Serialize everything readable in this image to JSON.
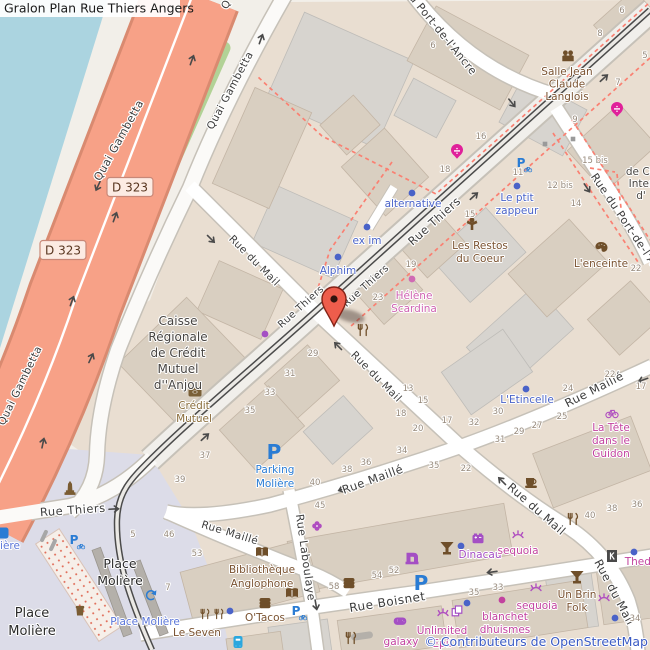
{
  "title": "Gralon Plan Rue Thiers Angers",
  "attribution": "© Contributeurs de OpenStreetMap",
  "colors": {
    "water": "#abd4e0",
    "land": "#f2efe9",
    "block": "#e9ded1",
    "square": "#dcdce8",
    "trunk_road": "#f7a187",
    "trunk_casing": "#d98a70",
    "grass": "#b2d296",
    "road_white": "#ffffff",
    "road_casing": "#c6c1b8",
    "main_road": "#f1efeb",
    "tram": "#4b4b4b",
    "building_tan": "#d9cfc1",
    "building_gray": "#d7d4cf",
    "footway_dashed": "#fa8072",
    "marker_red": "#ee5d4c",
    "street_text": "#3c3c3c",
    "housenumber_text": "#96897b",
    "office_blue": "#4a63c8",
    "amenity_brown": "#7a5230",
    "bank_brown": "#8a6d3b",
    "shop_pink": "#c2429f",
    "health_pink": "#cf63b2",
    "purple_shop": "#a44fc4",
    "parking_blue": "#2a7cd4",
    "transit_blue": "#5a75d8",
    "pharmacy_magenta": "#e0219a",
    "attribution_blue": "#3b5bc4"
  },
  "road_shields": [
    {
      "text": "D 323",
      "x": 130,
      "y": 187
    },
    {
      "text": "D 323",
      "x": 63,
      "y": 250
    }
  ],
  "street_labels": [
    {
      "text": "Quai Gambetta",
      "x": 122,
      "y": 142,
      "rot": -61,
      "size": 11
    },
    {
      "text": "Quai Gambetta",
      "x": 233,
      "y": 92,
      "rot": -62,
      "size": 10.5
    },
    {
      "text": "Quai Gambetta",
      "x": 23,
      "y": 387,
      "rot": -64,
      "size": 10.5
    },
    {
      "text": "Q",
      "x": 229,
      "y": 6,
      "rot": -62,
      "size": 10.5
    },
    {
      "text": "Rue Thiers",
      "x": 437,
      "y": 224,
      "rot": -42,
      "size": 11.5
    },
    {
      "text": "Rue Thiers",
      "x": 368,
      "y": 288,
      "rot": -42,
      "size": 10
    },
    {
      "text": "Rue Thiers",
      "x": 303,
      "y": 309,
      "rot": -42,
      "size": 10
    },
    {
      "text": "Rue Thiers",
      "x": 73,
      "y": 514,
      "rot": -4,
      "size": 11.5
    },
    {
      "text": "Rue du Mail",
      "x": 252,
      "y": 263,
      "rot": 45,
      "size": 10.5
    },
    {
      "text": "Rue du Mail",
      "x": 374,
      "y": 379,
      "rot": 45,
      "size": 10.5
    },
    {
      "text": "Rue du Mail",
      "x": 534,
      "y": 512,
      "rot": 41,
      "size": 11.5
    },
    {
      "text": "Rue du Mail",
      "x": 611,
      "y": 594,
      "rot": 62,
      "size": 11.5
    },
    {
      "text": "Rue Maillé",
      "x": 596,
      "y": 393,
      "rot": -27,
      "size": 11.5
    },
    {
      "text": "Rue Maillé",
      "x": 374,
      "y": 483,
      "rot": -20,
      "size": 11.5
    },
    {
      "text": "Rue Maillé",
      "x": 229,
      "y": 536,
      "rot": 17,
      "size": 10.5
    },
    {
      "text": "Rue Boisnet",
      "x": 388,
      "y": 606,
      "rot": -9,
      "size": 12
    },
    {
      "text": "Rue Laboulaye",
      "x": 302,
      "y": 558,
      "rot": 82,
      "size": 11
    },
    {
      "text": "du Port-de-l'Ancre",
      "x": 438,
      "y": 34,
      "rot": 51,
      "size": 11
    },
    {
      "text": "Rue du Port-de-l'Ancre",
      "x": 628,
      "y": 232,
      "rot": 56,
      "size": 11
    }
  ],
  "area_labels": [
    {
      "lines": [
        "Caisse",
        "Régionale",
        "de Crédit",
        "Mutuel",
        "d''Anjou"
      ],
      "x": 178,
      "y": 325,
      "lh": 16,
      "size": 12,
      "color": "#474441"
    },
    {
      "lines": [
        "Place",
        "Molière"
      ],
      "x": 120,
      "y": 568,
      "lh": 17,
      "size": 12.5,
      "color": "#2b2b2b"
    },
    {
      "lines": [
        "Place",
        "Molière"
      ],
      "x": 32,
      "y": 617,
      "lh": 18,
      "size": 13,
      "color": "#2b2b2b"
    },
    {
      "lines": [
        "de Co",
        "Inter",
        "d'"
      ],
      "x": 641,
      "y": 175,
      "lh": 12,
      "size": 10.5,
      "color": "#474441"
    }
  ],
  "poi_labels": [
    {
      "lines": [
        "alternative"
      ],
      "x": 413,
      "y": 207,
      "color": "office_blue"
    },
    {
      "lines": [
        "ex im"
      ],
      "x": 367,
      "y": 244,
      "color": "office_blue"
    },
    {
      "lines": [
        "Alphim"
      ],
      "x": 338,
      "y": 274,
      "color": "office_blue"
    },
    {
      "lines": [
        "Le ptit",
        "zappeur"
      ],
      "x": 517,
      "y": 201,
      "lh": 13,
      "color": "office_blue"
    },
    {
      "lines": [
        "L'Etincelle"
      ],
      "x": 527,
      "y": 403,
      "color": "office_blue"
    },
    {
      "lines": [
        "Dinacau"
      ],
      "x": 480,
      "y": 558,
      "color": "purple_shop"
    },
    {
      "lines": [
        "Parking",
        "Molière"
      ],
      "x": 275,
      "y": 473,
      "lh": 14,
      "color": "parking_blue"
    },
    {
      "lines": [
        "Place Molière"
      ],
      "x": 145,
      "y": 625,
      "color": "transit_blue"
    },
    {
      "lines": [
        "ière"
      ],
      "x": 10,
      "y": 549,
      "color": "transit_blue"
    },
    {
      "lines": [
        "Les Restos",
        "du Coeur"
      ],
      "x": 480,
      "y": 249,
      "lh": 13,
      "color": "amenity_brown"
    },
    {
      "lines": [
        "L'enceinte"
      ],
      "x": 601,
      "y": 267,
      "color": "amenity_brown"
    },
    {
      "lines": [
        "Salle Jean",
        "Claude",
        "Langlois"
      ],
      "x": 567,
      "y": 75,
      "lh": 12.5,
      "color": "amenity_brown"
    },
    {
      "lines": [
        "Crédit",
        "Mutuel"
      ],
      "x": 194,
      "y": 409,
      "lh": 13,
      "color": "bank_brown"
    },
    {
      "lines": [
        "Le Seven"
      ],
      "x": 197,
      "y": 636,
      "color": "amenity_brown"
    },
    {
      "lines": [
        "O'Tacos"
      ],
      "x": 265,
      "y": 621,
      "color": "amenity_brown"
    },
    {
      "lines": [
        "Bibliothèque",
        "Anglophone"
      ],
      "x": 262,
      "y": 573,
      "lh": 14,
      "color": "amenity_brown"
    },
    {
      "lines": [
        "Un Brin",
        "Folk"
      ],
      "x": 577,
      "y": 598,
      "lh": 13,
      "color": "amenity_brown"
    },
    {
      "lines": [
        "Hélène",
        "Scardina"
      ],
      "x": 414,
      "y": 299,
      "lh": 13,
      "color": "health_pink"
    },
    {
      "lines": [
        "sequoia"
      ],
      "x": 518,
      "y": 554,
      "color": "shop_pink"
    },
    {
      "lines": [
        "sequoia"
      ],
      "x": 537,
      "y": 609,
      "color": "shop_pink"
    },
    {
      "lines": [
        "blanchet",
        "dhuismes"
      ],
      "x": 505,
      "y": 620,
      "lh": 13,
      "color": "shop_pink"
    },
    {
      "lines": [
        "La Tête",
        "dans le",
        "Guidon"
      ],
      "x": 611,
      "y": 431,
      "lh": 13,
      "color": "shop_pink"
    },
    {
      "lines": [
        "galaxy"
      ],
      "x": 401,
      "y": 645,
      "color": "shop_pink"
    },
    {
      "lines": [
        "Unlimited",
        "Epil"
      ],
      "x": 442,
      "y": 634,
      "lh": 13,
      "color": "shop_pink"
    },
    {
      "lines": [
        "Thedr"
      ],
      "x": 640,
      "y": 565,
      "color": "shop_pink"
    }
  ],
  "house_numbers": [
    {
      "t": "6",
      "x": 622,
      "y": 13
    },
    {
      "t": "8",
      "x": 600,
      "y": 36
    },
    {
      "t": "5",
      "x": 645,
      "y": 58
    },
    {
      "t": "6",
      "x": 433,
      "y": 48
    },
    {
      "t": "7",
      "x": 618,
      "y": 85
    },
    {
      "t": "9",
      "x": 575,
      "y": 122
    },
    {
      "t": "16",
      "x": 481,
      "y": 139
    },
    {
      "t": "18",
      "x": 445,
      "y": 172
    },
    {
      "t": "15 bis",
      "x": 595,
      "y": 163
    },
    {
      "t": "12 bis",
      "x": 560,
      "y": 188
    },
    {
      "t": "14",
      "x": 576,
      "y": 206
    },
    {
      "t": "11",
      "x": 518,
      "y": 175
    },
    {
      "t": "15",
      "x": 470,
      "y": 217
    },
    {
      "t": "19",
      "x": 411,
      "y": 267
    },
    {
      "t": "23",
      "x": 378,
      "y": 300
    },
    {
      "t": "22",
      "x": 636,
      "y": 271
    },
    {
      "t": "29",
      "x": 313,
      "y": 356
    },
    {
      "t": "31",
      "x": 290,
      "y": 376
    },
    {
      "t": "33",
      "x": 270,
      "y": 395
    },
    {
      "t": "35",
      "x": 250,
      "y": 413
    },
    {
      "t": "37",
      "x": 205,
      "y": 458
    },
    {
      "t": "39",
      "x": 180,
      "y": 482
    },
    {
      "t": "13",
      "x": 408,
      "y": 391
    },
    {
      "t": "15",
      "x": 423,
      "y": 403
    },
    {
      "t": "18",
      "x": 401,
      "y": 416
    },
    {
      "t": "20",
      "x": 418,
      "y": 431
    },
    {
      "t": "17",
      "x": 447,
      "y": 423
    },
    {
      "t": "32",
      "x": 474,
      "y": 425
    },
    {
      "t": "30",
      "x": 498,
      "y": 414
    },
    {
      "t": "31",
      "x": 500,
      "y": 442
    },
    {
      "t": "29",
      "x": 519,
      "y": 434
    },
    {
      "t": "27",
      "x": 537,
      "y": 428
    },
    {
      "t": "25",
      "x": 562,
      "y": 419
    },
    {
      "t": "24",
      "x": 568,
      "y": 391
    },
    {
      "t": "22",
      "x": 610,
      "y": 377
    },
    {
      "t": "17",
      "x": 641,
      "y": 389
    },
    {
      "t": "34",
      "x": 402,
      "y": 453
    },
    {
      "t": "36",
      "x": 366,
      "y": 465
    },
    {
      "t": "38",
      "x": 347,
      "y": 472
    },
    {
      "t": "40",
      "x": 315,
      "y": 485
    },
    {
      "t": "35",
      "x": 434,
      "y": 468
    },
    {
      "t": "22",
      "x": 466,
      "y": 471
    },
    {
      "t": "45",
      "x": 320,
      "y": 508
    },
    {
      "t": "5",
      "x": 133,
      "y": 537
    },
    {
      "t": "46",
      "x": 169,
      "y": 537
    },
    {
      "t": "53",
      "x": 197,
      "y": 556
    },
    {
      "t": "7",
      "x": 168,
      "y": 590
    },
    {
      "t": "40",
      "x": 590,
      "y": 518
    },
    {
      "t": "38",
      "x": 612,
      "y": 511
    },
    {
      "t": "36",
      "x": 637,
      "y": 507
    },
    {
      "t": "54",
      "x": 377,
      "y": 578
    },
    {
      "t": "52",
      "x": 394,
      "y": 573
    },
    {
      "t": "58",
      "x": 334,
      "y": 589
    },
    {
      "t": "35",
      "x": 474,
      "y": 595
    },
    {
      "t": "33",
      "x": 498,
      "y": 590
    },
    {
      "t": "34",
      "x": 635,
      "y": 621
    }
  ],
  "icons": [
    {
      "n": "restaurant-icon",
      "s": "fork",
      "x": 363,
      "y": 330,
      "c": "#6f4f2a"
    },
    {
      "n": "restaurant-icon",
      "s": "fork",
      "x": 573,
      "y": 519,
      "c": "#6f4f2a"
    },
    {
      "n": "restaurant-icon",
      "s": "fork",
      "x": 351,
      "y": 638,
      "c": "#6f4f2a"
    },
    {
      "n": "restaurant-icon",
      "s": "fork",
      "x": 205,
      "y": 614,
      "c": "#6f4f2a",
      "sc": 0.85
    },
    {
      "n": "restaurant-icon",
      "s": "fork",
      "x": 219,
      "y": 614,
      "c": "#6f4f2a",
      "sc": 0.85
    },
    {
      "n": "fast-food-icon",
      "s": "burger",
      "x": 265,
      "y": 603,
      "c": "#6f4f2a"
    },
    {
      "n": "fast-food-icon",
      "s": "burger",
      "x": 349,
      "y": 583,
      "c": "#6f4f2a"
    },
    {
      "n": "cafe-icon",
      "s": "cup",
      "x": 531,
      "y": 482,
      "c": "#6f4f2a"
    },
    {
      "n": "bar-icon",
      "s": "cocktail",
      "x": 447,
      "y": 548,
      "c": "#6f4f2a"
    },
    {
      "n": "bar-icon",
      "s": "cocktail",
      "x": 577,
      "y": 577,
      "c": "#6f4f2a"
    },
    {
      "n": "library-icon",
      "s": "book",
      "x": 262,
      "y": 552,
      "c": "#6f4f2a"
    },
    {
      "n": "library-icon",
      "s": "book",
      "x": 292,
      "y": 593,
      "c": "#6f4f2a"
    },
    {
      "n": "social-facility-icon",
      "s": "charity",
      "x": 472,
      "y": 224,
      "c": "#6f4f2a"
    },
    {
      "n": "community-centre-icon",
      "s": "people",
      "x": 568,
      "y": 56,
      "c": "#6f4f2a"
    },
    {
      "n": "art-gallery-icon",
      "s": "palette",
      "x": 601,
      "y": 247,
      "c": "#6f4f2a"
    },
    {
      "n": "bank-icon",
      "s": "bank",
      "x": 195,
      "y": 392,
      "c": "#7a6038"
    },
    {
      "n": "monument-icon",
      "s": "monument",
      "x": 70,
      "y": 489,
      "c": "#7a5c33"
    },
    {
      "n": "waste-basket-icon",
      "s": "trash",
      "x": 80,
      "y": 610,
      "c": "#7a5c33"
    },
    {
      "n": "pharmacy-icon",
      "s": "pharmacy",
      "x": 457,
      "y": 152,
      "c": "#e0219a"
    },
    {
      "n": "pharmacy-icon",
      "s": "pharmacy",
      "x": 617,
      "y": 110,
      "c": "#e0219a"
    },
    {
      "n": "beauty-salon-icon",
      "s": "eyelash",
      "x": 518,
      "y": 536,
      "c": "#b04fc0"
    },
    {
      "n": "beauty-salon-icon",
      "s": "eyelash",
      "x": 536,
      "y": 589,
      "c": "#b04fc0"
    },
    {
      "n": "beauty-salon-icon",
      "s": "eyelash",
      "x": 604,
      "y": 599,
      "c": "#b04fc0"
    },
    {
      "n": "beauty-salon-icon",
      "s": "eyelash",
      "x": 443,
      "y": 614,
      "c": "#b04fc0"
    },
    {
      "n": "bicycle-shop-icon",
      "s": "bike",
      "x": 612,
      "y": 413,
      "c": "#b04fc0"
    },
    {
      "n": "florist-icon",
      "s": "flower",
      "x": 317,
      "y": 526,
      "c": "#b04fc0"
    },
    {
      "n": "video-game-shop-icon",
      "s": "controller",
      "x": 400,
      "y": 621,
      "c": "#a44fc4"
    },
    {
      "n": "battery-shop-icon",
      "s": "battery",
      "x": 478,
      "y": 539,
      "c": "#a44fc4"
    },
    {
      "n": "sewing-shop-icon",
      "s": "sewing",
      "x": 412,
      "y": 558,
      "c": "#a44fc4"
    },
    {
      "n": "copyshop-icon",
      "s": "copy",
      "x": 457,
      "y": 611,
      "c": "#a44fc4"
    },
    {
      "n": "cinema-icon",
      "s": "kbox",
      "x": 612,
      "y": 556,
      "c": "#4a4a4a"
    },
    {
      "n": "bus-stop-icon",
      "s": "bus",
      "x": 238,
      "y": 642,
      "c": "#2aa7de"
    },
    {
      "n": "tram-terminus-icon",
      "s": "tramloop",
      "x": 151,
      "y": 595,
      "c": "#2a7cd4"
    },
    {
      "n": "parking-icon",
      "s": "bigP",
      "x": 274,
      "y": 452,
      "c": "#2a7cd4"
    },
    {
      "n": "parking-icon",
      "s": "bigP",
      "x": 421,
      "y": 583,
      "c": "#2a7cd4"
    },
    {
      "n": "bicycle-parking-icon",
      "s": "pbike",
      "x": 521,
      "y": 163,
      "c": "#2a7cd4"
    },
    {
      "n": "bicycle-parking-icon",
      "s": "pbike",
      "x": 74,
      "y": 540,
      "c": "#2a7cd4"
    },
    {
      "n": "bicycle-parking-icon",
      "s": "pbike",
      "x": 296,
      "y": 611,
      "c": "#2a7cd4"
    },
    {
      "n": "transit-icon-partial",
      "s": "bluebox",
      "x": 3,
      "y": 533,
      "c": "#2a7cd4"
    },
    {
      "n": "poi-dot",
      "s": "dot",
      "x": 412,
      "y": 193,
      "c": "#4a63c8"
    },
    {
      "n": "poi-dot",
      "s": "dot",
      "x": 367,
      "y": 227,
      "c": "#4a63c8"
    },
    {
      "n": "poi-dot",
      "s": "dot",
      "x": 338,
      "y": 257,
      "c": "#4a63c8"
    },
    {
      "n": "poi-dot",
      "s": "dot",
      "x": 517,
      "y": 186,
      "c": "#4a63c8"
    },
    {
      "n": "poi-dot",
      "s": "dot",
      "x": 526,
      "y": 389,
      "c": "#4a63c8"
    },
    {
      "n": "poi-dot",
      "s": "dot",
      "x": 461,
      "y": 546,
      "c": "#4a63c8"
    },
    {
      "n": "poi-dot",
      "s": "dot",
      "x": 230,
      "y": 611,
      "c": "#4a63c8"
    },
    {
      "n": "poi-dot",
      "s": "dot",
      "x": 634,
      "y": 552,
      "c": "#4a63c8"
    },
    {
      "n": "poi-dot",
      "s": "dot",
      "x": 615,
      "y": 618,
      "c": "#4a63c8"
    },
    {
      "n": "poi-dot",
      "s": "dot",
      "x": 467,
      "y": 603,
      "c": "#4a63c8"
    },
    {
      "n": "poi-dot",
      "s": "dot",
      "x": 412,
      "y": 279,
      "c": "#d06ab4"
    },
    {
      "n": "poi-dot",
      "s": "dot",
      "x": 265,
      "y": 334,
      "c": "#a44fc4"
    },
    {
      "n": "poi-dot",
      "s": "dot",
      "x": 502,
      "y": 600,
      "c": "#c2429f"
    },
    {
      "n": "utility-marker",
      "s": "sq",
      "x": 545,
      "y": 144,
      "c": "#9a9a9a"
    },
    {
      "n": "utility-marker",
      "s": "sq",
      "x": 573,
      "y": 139,
      "c": "#9a9a9a"
    }
  ],
  "oneway_arrows": [
    {
      "x": 604,
      "y": 78,
      "rot": -42
    },
    {
      "x": 474,
      "y": 196,
      "rot": -42
    },
    {
      "x": 205,
      "y": 437,
      "rot": -42
    },
    {
      "x": 512,
      "y": 103,
      "rot": 51
    },
    {
      "x": 587,
      "y": 188,
      "rot": 56
    },
    {
      "x": 211,
      "y": 239,
      "rot": 45
    },
    {
      "x": 338,
      "y": 346,
      "rot": -135
    },
    {
      "x": 502,
      "y": 481,
      "rot": -135
    },
    {
      "x": 643,
      "y": 380,
      "rot": 160
    },
    {
      "x": 343,
      "y": 489,
      "rot": 160
    },
    {
      "x": 492,
      "y": 572,
      "rot": 172
    },
    {
      "x": 91,
      "y": 358,
      "rot": -65
    },
    {
      "x": 261,
      "y": 39,
      "rot": -70
    },
    {
      "x": 43,
      "y": 443,
      "rot": -78
    },
    {
      "x": 192,
      "y": 60,
      "rot": -70
    },
    {
      "x": 115,
      "y": 217,
      "rot": -70
    },
    {
      "x": 72,
      "y": 301,
      "rot": -70
    },
    {
      "x": 98,
      "y": 186,
      "rot": 115
    },
    {
      "x": 316,
      "y": 605,
      "rot": 80
    },
    {
      "x": 114,
      "y": 509,
      "rot": -3
    }
  ],
  "marker": {
    "x": 334,
    "y": 326
  }
}
